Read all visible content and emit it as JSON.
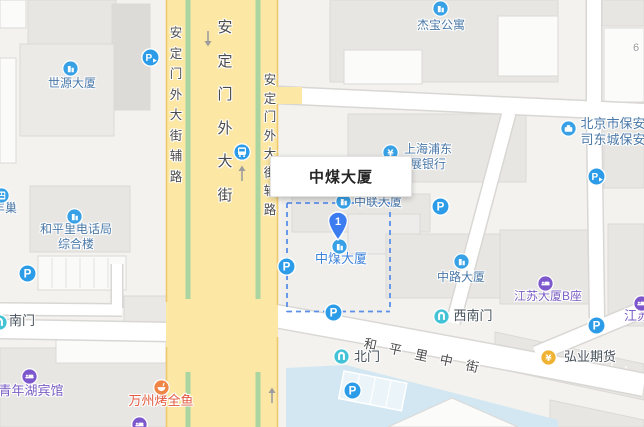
{
  "map": {
    "infobox": {
      "title": "中煤大厦"
    },
    "marker": {
      "label": "1",
      "x": 338,
      "y": 240
    },
    "building_number": {
      "text": "6",
      "x": 636,
      "y": 42
    },
    "pois": [
      {
        "id": "shiyuan-daxia",
        "text": "世源大厦",
        "icon": "building",
        "ix": 70,
        "iy": 68,
        "tx": 72,
        "ty": 77,
        "cls": "blue"
      },
      {
        "id": "fengchao",
        "text": "丰巢",
        "icon": "locker",
        "ix": 1,
        "iy": 195,
        "tx": 5,
        "ty": 202,
        "cls": "blue"
      },
      {
        "id": "hepingli-telephone",
        "lines": [
          "和平里电话局",
          "综合楼"
        ],
        "icon": "building",
        "ix": 74,
        "iy": 216,
        "tx": 76,
        "ty": 223,
        "lh": 15,
        "cls": "blue"
      },
      {
        "id": "jiebao-gongyu",
        "text": "杰宝公寓",
        "icon": "building",
        "ix": 440,
        "iy": 8,
        "tx": 441,
        "ty": 19,
        "cls": "blue"
      },
      {
        "id": "spd-bank",
        "lines": [
          "上海浦东",
          "展银行"
        ],
        "icon": "bank",
        "ix": 390,
        "iy": 152,
        "tx": 428,
        "ty": 143,
        "lh": 15,
        "cls": "blue"
      },
      {
        "id": "beijing-baoan",
        "lines": [
          "北京市保安服务",
          "司东城保安分公"
        ],
        "icon": "company",
        "ix": 568,
        "iy": 128,
        "tx": 626,
        "ty": 117,
        "lh": 16,
        "cls": "blue",
        "size": 13
      },
      {
        "id": "zhonglian-daxia",
        "text": "中联大厦",
        "icon": "building",
        "ix": 343,
        "iy": 201,
        "tx": 378,
        "ty": 196,
        "cls": "blue"
      },
      {
        "id": "zhongmei-daxia-poi",
        "text": "中煤大厦",
        "icon": "building",
        "ix": 339,
        "iy": 246,
        "tx": 341,
        "ty": 252,
        "cls": "bright-blue",
        "size": 13
      },
      {
        "id": "zhonglu-daxia",
        "text": "中路大厦",
        "icon": "building",
        "ix": 461,
        "iy": 261,
        "tx": 461,
        "ty": 271,
        "cls": "blue"
      },
      {
        "id": "jiangsu-daxia-b",
        "text": "江苏大厦B座",
        "icon": "hotel",
        "ix": 545,
        "iy": 283,
        "tx": 548,
        "ty": 290,
        "cls": "purple"
      },
      {
        "id": "jiangsu-cut",
        "text": "江苏",
        "icon": "hotel",
        "ix": 641,
        "iy": 303,
        "tx": 637,
        "ty": 309,
        "cls": "purple",
        "size": 13
      },
      {
        "id": "qingnianhu-binguan",
        "text": "青年湖宾馆",
        "icon": "hotel",
        "ix": 29,
        "iy": 376,
        "tx": 31,
        "ty": 384,
        "cls": "purple",
        "size": 13
      },
      {
        "id": "wanzhou-kaoquanyu",
        "text": "万州烤全鱼",
        "icon": "restaurant",
        "ix": 161,
        "iy": 387,
        "tx": 161,
        "ty": 394,
        "cls": "orange",
        "size": 13
      },
      {
        "id": "hongye-qihuo",
        "text": "弘业期货",
        "icon": "finance",
        "ix": 548,
        "iy": 357,
        "tx": 590,
        "ty": 350,
        "cls": "dark",
        "size": 13
      },
      {
        "id": "beimen-gate",
        "text": "北门",
        "icon": "gate",
        "ix": 341,
        "iy": 356,
        "tx": 367,
        "ty": 350,
        "cls": "dark",
        "size": 13
      },
      {
        "id": "xinanmen-gate",
        "text": "西南门",
        "icon": "gate",
        "ix": 441,
        "iy": 316,
        "tx": 473,
        "ty": 309,
        "cls": "dark",
        "size": 13
      },
      {
        "id": "nanmen-gate",
        "text": "南门",
        "icon": "gate",
        "ix": -1,
        "iy": 322,
        "tx": 22,
        "ty": 314,
        "cls": "dark",
        "size": 13
      },
      {
        "id": "purple-poi-partial",
        "text": "",
        "icon": "hotel",
        "ix": 139,
        "iy": 424,
        "cls": "purple"
      }
    ],
    "parking": [
      {
        "x": 27,
        "y": 273
      },
      {
        "x": 286,
        "y": 266
      },
      {
        "x": 333,
        "y": 312
      },
      {
        "x": 352,
        "y": 390
      },
      {
        "x": 440,
        "y": 206
      },
      {
        "x": 596,
        "y": 325
      }
    ],
    "parking_entrances": [
      {
        "x": 150,
        "y": 57
      },
      {
        "x": 596,
        "y": 176
      }
    ],
    "bus_stop": {
      "x": 242,
      "y": 152
    },
    "road_labels": [
      {
        "text": "安定门外大街",
        "type": "v",
        "x": 224,
        "y": 16,
        "spacing": 33.5,
        "size": 15
      },
      {
        "text": "安定门外大街辅路",
        "type": "v",
        "x": 175,
        "y": 22,
        "spacing": 20.5,
        "size": 12.5
      },
      {
        "text": "安定门外大街辅路",
        "type": "v",
        "x": 269,
        "y": 69,
        "spacing": 18.5,
        "size": 12.5
      },
      {
        "text": "和平里中街",
        "type": "d",
        "x": 363,
        "y": 334,
        "spacing": 26,
        "size": 13,
        "angle": 12
      }
    ],
    "colors": {
      "poi_blue": "#38a1e6",
      "poi_purple": "#7d57cc",
      "poi_orange": "#ee8446",
      "poi_yellow": "#f0b232",
      "poi_teal": "#44c3d6",
      "parking_blue": "#2d9ce8",
      "pin_blue": "#3b7df0",
      "road_yellow": "#fce7a4",
      "road_border": "#efc96e",
      "green_median": "#aad4a0",
      "water": "#d2e7f2",
      "boundary_dash": "#5b8fe8"
    }
  }
}
